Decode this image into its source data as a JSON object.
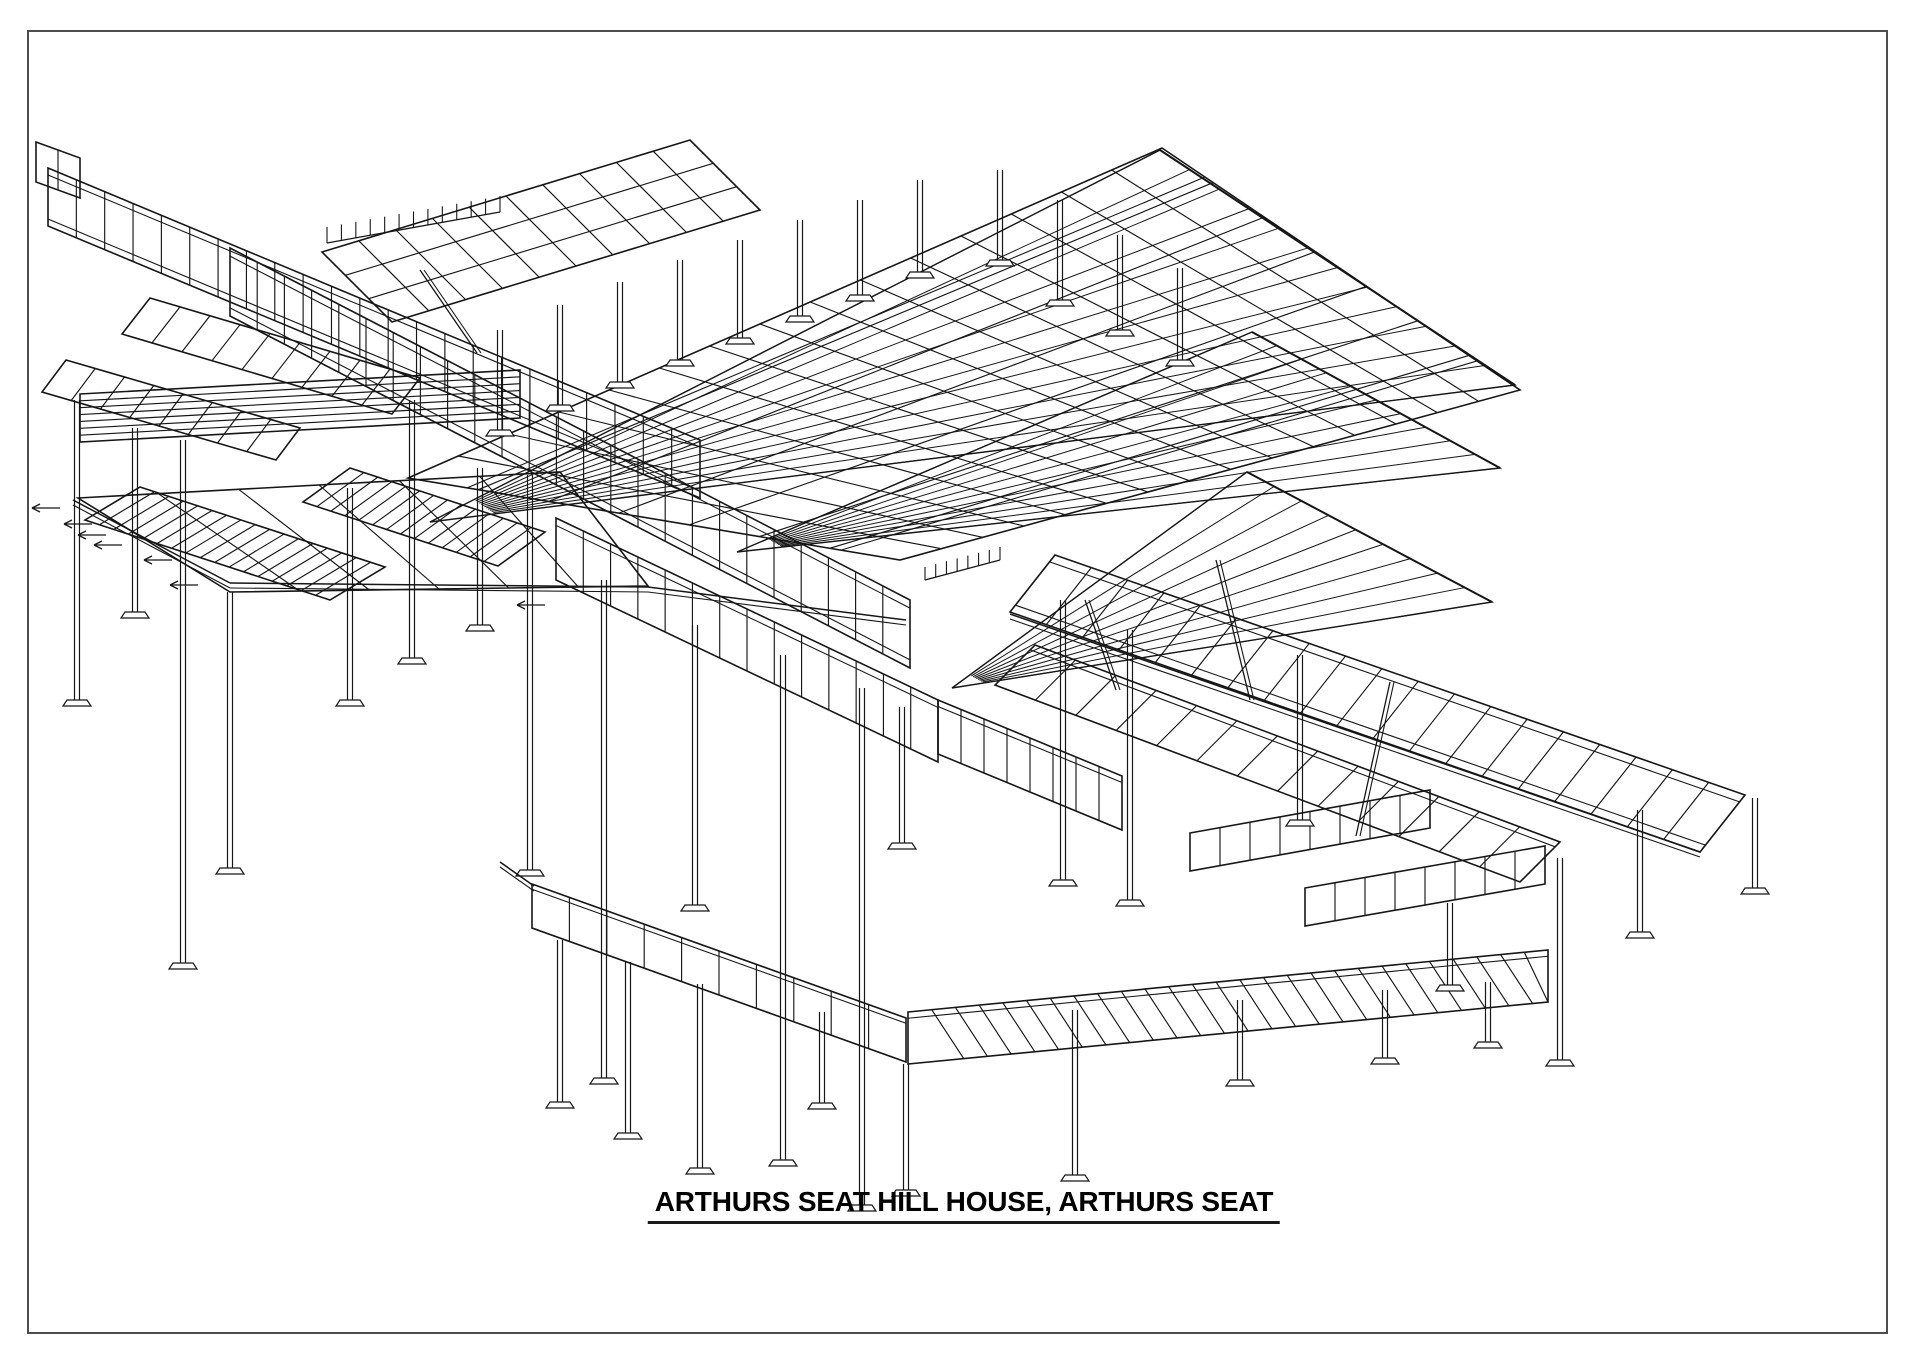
{
  "title": {
    "text": "ARTHURS SEAT HILL HOUSE, ARTHURS SEAT"
  },
  "page": {
    "background": "#ffffff",
    "border_color": "#4d4d4d",
    "line_color": "#161616"
  },
  "drawing": {
    "kind": "isometric-structural-steel-framing-wireframe",
    "panels": [
      {
        "name": "cap-top-left",
        "pts": [
          [
            36,
            142
          ],
          [
            80,
            158
          ],
          [
            80,
            198
          ],
          [
            36,
            182
          ]
        ],
        "rungs": 1,
        "rails": 0,
        "cross": 0
      },
      {
        "name": "deck-upper-left",
        "pts": [
          [
            48,
            168
          ],
          [
            700,
            440
          ],
          [
            700,
            498
          ],
          [
            48,
            226
          ]
        ],
        "rungs": 22,
        "rails": 2,
        "cross": 0
      },
      {
        "name": "ladder-left-1",
        "pts": [
          [
            150,
            298
          ],
          [
            420,
            378
          ],
          [
            392,
            414
          ],
          [
            122,
            334
          ]
        ],
        "rungs": 8,
        "rails": 0,
        "cross": 0
      },
      {
        "name": "ladder-left-2",
        "pts": [
          [
            66,
            360
          ],
          [
            300,
            428
          ],
          [
            276,
            460
          ],
          [
            42,
            392
          ]
        ],
        "rungs": 7,
        "rails": 0,
        "cross": 0
      },
      {
        "name": "pergola-planks",
        "pts": [
          [
            80,
            394
          ],
          [
            520,
            370
          ],
          [
            520,
            418
          ],
          [
            80,
            442
          ]
        ],
        "rungs": 0,
        "rails": 0,
        "cross": 6
      },
      {
        "name": "joist-field-1",
        "pts": [
          [
            140,
            487
          ],
          [
            385,
            567
          ],
          [
            330,
            600
          ],
          [
            85,
            520
          ]
        ],
        "rungs": 16,
        "rails": 0,
        "cross": 0
      },
      {
        "name": "joist-field-2",
        "pts": [
          [
            350,
            468
          ],
          [
            545,
            532
          ],
          [
            498,
            566
          ],
          [
            303,
            502
          ]
        ],
        "rungs": 13,
        "rails": 0,
        "cross": 0
      },
      {
        "name": "left-platform",
        "pts": [
          [
            78,
            498
          ],
          [
            560,
            472
          ],
          [
            648,
            586
          ],
          [
            230,
            592
          ]
        ],
        "rungs": 5,
        "rails": 0,
        "cross": 0
      },
      {
        "name": "spine-walkway",
        "pts": [
          [
            230,
            248
          ],
          [
            910,
            600
          ],
          [
            910,
            668
          ],
          [
            230,
            316
          ]
        ],
        "rungs": 24,
        "rails": 2,
        "cross": 0
      },
      {
        "name": "spine-walkway-2",
        "pts": [
          [
            556,
            518
          ],
          [
            938,
            700
          ],
          [
            938,
            762
          ],
          [
            556,
            580
          ]
        ],
        "rungs": 13,
        "rails": 1,
        "cross": 0
      },
      {
        "name": "spine-walkway-3",
        "pts": [
          [
            938,
            700
          ],
          [
            1122,
            776
          ],
          [
            1122,
            830
          ],
          [
            938,
            754
          ]
        ],
        "rungs": 7,
        "rails": 1,
        "cross": 0
      },
      {
        "name": "roof-grid-upper-left",
        "pts": [
          [
            322,
            252
          ],
          [
            690,
            140
          ],
          [
            760,
            210
          ],
          [
            392,
            322
          ]
        ],
        "rungs": 9,
        "rails": 0,
        "cross": 2
      },
      {
        "name": "roof-grid-main",
        "pts": [
          [
            408,
            478
          ],
          [
            1162,
            148
          ],
          [
            1520,
            390
          ],
          [
            900,
            560
          ]
        ],
        "rungs": 14,
        "rails": 2,
        "cross": 6
      },
      {
        "name": "right-deck",
        "pts": [
          [
            1055,
            555
          ],
          [
            1745,
            795
          ],
          [
            1700,
            852
          ],
          [
            1010,
            612
          ]
        ],
        "rungs": 18,
        "rails": 2,
        "cross": 0
      },
      {
        "name": "right-deck-lower",
        "pts": [
          [
            1035,
            645
          ],
          [
            1560,
            842
          ],
          [
            1520,
            882
          ],
          [
            995,
            685
          ]
        ],
        "rungs": 12,
        "rails": 1,
        "cross": 0
      },
      {
        "name": "bottom-walkway",
        "pts": [
          [
            532,
            884
          ],
          [
            906,
            1018
          ],
          [
            906,
            1062
          ],
          [
            532,
            928
          ]
        ],
        "rungs": 9,
        "rails": 1,
        "cross": 0
      },
      {
        "name": "bottom-deck",
        "pts": [
          [
            908,
            1012
          ],
          [
            1548,
            950
          ],
          [
            1548,
            1002
          ],
          [
            908,
            1064
          ]
        ],
        "rungs": 26,
        "rails": 1,
        "cross": 0,
        "skew": 0.05
      },
      {
        "name": "bottom-strip-1",
        "pts": [
          [
            1190,
            833
          ],
          [
            1430,
            790
          ],
          [
            1430,
            828
          ],
          [
            1190,
            871
          ]
        ],
        "rungs": 7,
        "rails": 0,
        "cross": 0
      },
      {
        "name": "bottom-strip-2",
        "pts": [
          [
            1305,
            888
          ],
          [
            1545,
            846
          ],
          [
            1545,
            884
          ],
          [
            1305,
            926
          ]
        ],
        "rungs": 7,
        "rails": 0,
        "cross": 0
      }
    ],
    "fans": [
      {
        "name": "roof-sail-1",
        "apex": [
          430,
          522
        ],
        "b": [
          1160,
          150
        ],
        "c": [
          1515,
          385
        ],
        "lines": 12
      },
      {
        "name": "roof-sail-2",
        "apex": [
          737,
          552
        ],
        "b": [
          1252,
          332
        ],
        "c": [
          1500,
          468
        ],
        "lines": 10
      },
      {
        "name": "roof-sail-3",
        "apex": [
          952,
          688
        ],
        "b": [
          1247,
          472
        ],
        "c": [
          1492,
          602
        ],
        "lines": 9
      }
    ],
    "columns": [
      [
        77,
        400,
        700
      ],
      [
        135,
        428,
        612
      ],
      [
        183,
        440,
        963
      ],
      [
        230,
        592,
        868
      ],
      [
        350,
        488,
        700
      ],
      [
        412,
        400,
        658
      ],
      [
        480,
        468,
        625
      ],
      [
        530,
        475,
        870
      ],
      [
        604,
        580,
        1078
      ],
      [
        695,
        625,
        905
      ],
      [
        783,
        655,
        1160
      ],
      [
        862,
        688,
        1205
      ],
      [
        902,
        707,
        843
      ],
      [
        560,
        940,
        1102
      ],
      [
        628,
        962,
        1133
      ],
      [
        700,
        984,
        1168
      ],
      [
        822,
        1012,
        1103
      ],
      [
        906,
        1064,
        1190
      ],
      [
        1075,
        1010,
        1175
      ],
      [
        1240,
        1000,
        1080
      ],
      [
        1385,
        990,
        1058
      ],
      [
        1488,
        982,
        1042
      ],
      [
        1560,
        858,
        1060
      ],
      [
        1640,
        810,
        932
      ],
      [
        1755,
        798,
        888
      ],
      [
        1450,
        903,
        985
      ],
      [
        1063,
        600,
        880
      ],
      [
        1130,
        630,
        900
      ],
      [
        1300,
        655,
        820
      ],
      [
        500,
        330,
        430
      ],
      [
        560,
        305,
        405
      ],
      [
        620,
        282,
        382
      ],
      [
        680,
        260,
        360
      ],
      [
        740,
        240,
        338
      ],
      [
        800,
        220,
        316
      ],
      [
        860,
        200,
        295
      ],
      [
        920,
        180,
        272
      ],
      [
        1000,
        170,
        260
      ],
      [
        1060,
        200,
        300
      ],
      [
        1120,
        235,
        330
      ],
      [
        1180,
        268,
        360
      ]
    ],
    "braces": [
      [
        1085,
        600,
        1116,
        690
      ],
      [
        1390,
        682,
        1356,
        836
      ],
      [
        1216,
        560,
        1250,
        700
      ],
      [
        420,
        270,
        477,
        353
      ]
    ],
    "beams": [
      [
        73,
        500,
        230,
        583
      ],
      [
        230,
        583,
        648,
        587
      ],
      [
        648,
        587,
        906,
        620
      ],
      [
        500,
        862,
        534,
        886
      ],
      [
        1010,
        614,
        1700,
        852
      ]
    ],
    "arrows": [
      [
        60,
        508
      ],
      [
        92,
        524
      ],
      [
        106,
        535
      ],
      [
        122,
        545
      ],
      [
        172,
        560
      ],
      [
        198,
        585
      ],
      [
        545,
        605
      ]
    ],
    "hatch_strips": [
      {
        "from": [
          327,
          243
        ],
        "to": [
          500,
          212
        ],
        "ticks": 12,
        "len": 16
      },
      {
        "from": [
          925,
          580
        ],
        "to": [
          1000,
          560
        ],
        "ticks": 7,
        "len": 13
      }
    ]
  }
}
